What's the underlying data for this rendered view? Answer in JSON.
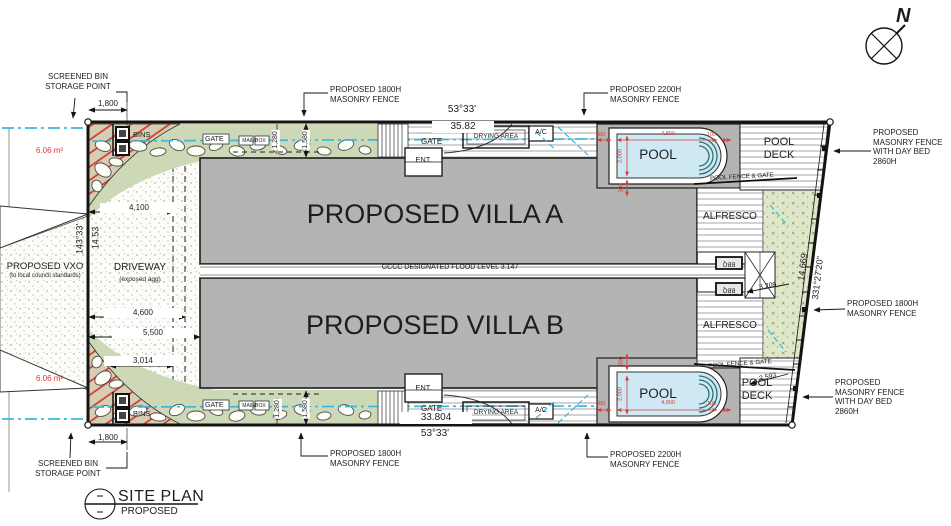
{
  "colors": {
    "building_gray": "#b4b4b2",
    "pool_water": "#cfe9f4",
    "garden_green": "#ccd8b6",
    "landscape_green": "#dfe7cb",
    "dimension_red": "#d93a35",
    "service_cyan": "#3db7de",
    "line_black": "#141414"
  },
  "north": {
    "label": "N"
  },
  "title_block": {
    "title": "SITE PLAN",
    "subtitle": "PROPOSED"
  },
  "villas": {
    "a": "PROPOSED VILLA A",
    "b": "PROPOSED VILLA B"
  },
  "flood_level": "GCCC DESIGNATED FLOOD LEVEL 3.147",
  "areas": {
    "pool": "POOL",
    "pool_deck": "POOL\nDECK",
    "alfresco": "ALFRESCO",
    "ent": "ENT.",
    "gate": "GATE",
    "drying_area": "DRYING AREA",
    "ac": "A/C",
    "bins": "BINS",
    "bbq": "BBQ",
    "mail_box": "MAIL BOX",
    "driveway": "DRIVEWAY",
    "driveway_note": "(exposed agg)",
    "pool_fence_gate": "POOL FENCE & GATE",
    "vxo": "PROPOSED VXO",
    "vxo_note": "(to local council standards)"
  },
  "callouts": {
    "screened_bin": "SCREENED BIN\nSTORAGE POINT",
    "fence_1800": "PROPOSED 1800H\nMASONRY FENCE",
    "fence_2200": "PROPOSED 2200H\nMASONRY FENCE",
    "fence_daybed": "PROPOSED\nMASONRY FENCE\nWITH DAY BED\n2860H"
  },
  "dims": {
    "top_bearing": "53°33'",
    "top_length": "35.82",
    "bottom_length": "33.804",
    "bottom_bearing": "53°33'",
    "left_bearing": "143°33'",
    "left_length": "14.53",
    "right_length": "14.669",
    "right_bearing": "331°27'20\"",
    "bin_width": "1,800",
    "d4100": "4,100",
    "d4600": "4,600",
    "d5500": "5,500",
    "d3014": "3,014",
    "d1580": "1,580",
    "d1280": "1,280",
    "d3209": "3,209",
    "d2593": "2,593",
    "pool_length": "4,800",
    "pool_width": "2,000",
    "off_100": "100",
    "off_300": "300",
    "bin_area": "6.06 m²"
  }
}
